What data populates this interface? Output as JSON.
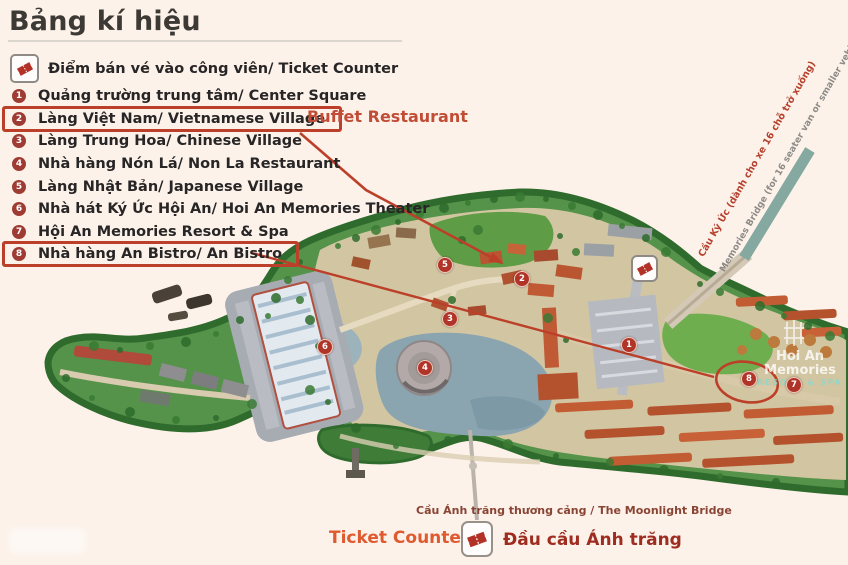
{
  "title": "Bảng kí hiệu",
  "ticket_legend": {
    "label": "Điểm bán vé vào công viên/ Ticket Counter",
    "icon": "ticket-icon"
  },
  "legend": {
    "items": [
      {
        "num": "1",
        "label": "Quảng trường trung tâm/ Center Square",
        "highlighted": false
      },
      {
        "num": "2",
        "label": "Làng Việt Nam/ Vietnamese Village",
        "highlighted": true
      },
      {
        "num": "3",
        "label": "Làng Trung Hoa/ Chinese Village",
        "highlighted": false
      },
      {
        "num": "4",
        "label": "Nhà hàng Nón Lá/ Non La Restaurant",
        "highlighted": false
      },
      {
        "num": "5",
        "label": "Làng Nhật Bản/ Japanese Village",
        "highlighted": false
      },
      {
        "num": "6",
        "label": "Nhà hát Ký Ức Hội An/ Hoi An Memories Theater",
        "highlighted": false
      },
      {
        "num": "7",
        "label": "Hội An Memories Resort & Spa",
        "highlighted": false
      },
      {
        "num": "8",
        "label": "Nhà hàng An Bistro/ An Bistro",
        "highlighted": true
      }
    ]
  },
  "annotations": {
    "buffet_label": "Buffet Restaurant",
    "memories_bridge_label_vi": "Cầu Ký Ức (dành cho xe 16 chỗ trở xuống)",
    "memories_bridge_label_en": "Memories Bridge (for 16 seater van or smaller vehicles)",
    "moonlight_bridge_label": "Cầu Ánh trăng thương cảng / The Moonlight Bridge",
    "ticket_counter_label": "Ticket Counter",
    "moonlight_head_label": "Đầu cầu Ánh trăng"
  },
  "map": {
    "markers": [
      {
        "num": "1",
        "x": 628,
        "y": 344
      },
      {
        "num": "2",
        "x": 521,
        "y": 278
      },
      {
        "num": "3",
        "x": 449,
        "y": 318
      },
      {
        "num": "4",
        "x": 424,
        "y": 367
      },
      {
        "num": "5",
        "x": 444,
        "y": 264
      },
      {
        "num": "6",
        "x": 324,
        "y": 346
      },
      {
        "num": "7",
        "x": 793,
        "y": 384
      },
      {
        "num": "8",
        "x": 748,
        "y": 378
      }
    ],
    "watermark_line1": "Hoi An Memories",
    "watermark_line2": "RESORT & SPA"
  },
  "colors": {
    "background": "#fcf2ea",
    "title_text": "#3d3935",
    "legend_text": "#272525",
    "legend_circle": "#9e3c33",
    "annotation_red": "#bc4029",
    "buffet_orange": "#c24d36",
    "ticket_counter_orange": "#df5a2e",
    "moonlight_head_red": "#9e2d20",
    "ticket_glyph_red": "#b23227",
    "island_green": "#55924a",
    "bridge_teal": "#85a9a0"
  }
}
